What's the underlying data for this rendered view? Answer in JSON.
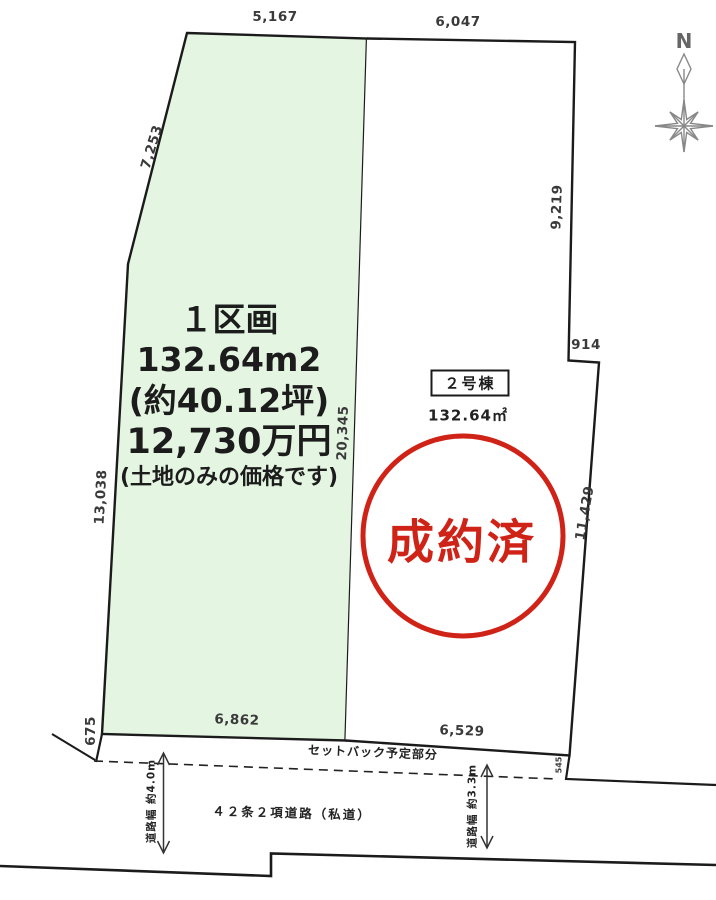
{
  "plan": {
    "compass": {
      "north_label": "N"
    },
    "parcel1": {
      "title": "１区画",
      "area_m2": "132.64m2",
      "area_tsubo": "(約40.12坪)",
      "price": "12,730万円",
      "price_note": "(土地のみの価格です)"
    },
    "parcel2": {
      "building_label": "２号棟",
      "area": "132.64㎡",
      "stamp": "成約済"
    },
    "dimensions": {
      "top_left": "5,167",
      "top_right": "6,047",
      "upper_left": "7,253",
      "right_upper": "9,219",
      "right_step": "914",
      "center_divider": "20,345",
      "left_side": "13,038",
      "right_lower": "11,429",
      "left_setback": "675",
      "bottom_left": "6,862",
      "bottom_right": "6,529",
      "right_setback": "545"
    },
    "road": {
      "setback_label": "セットバック予定部分",
      "name": "４２条２項道路（私道）",
      "width_left": "道路幅 約4.0m",
      "width_right": "道路幅 約3.3m"
    }
  },
  "colors": {
    "parcel1_fill": "#e4f6e2",
    "stamp_red": "#d02317",
    "line": "#1b1b1b"
  }
}
